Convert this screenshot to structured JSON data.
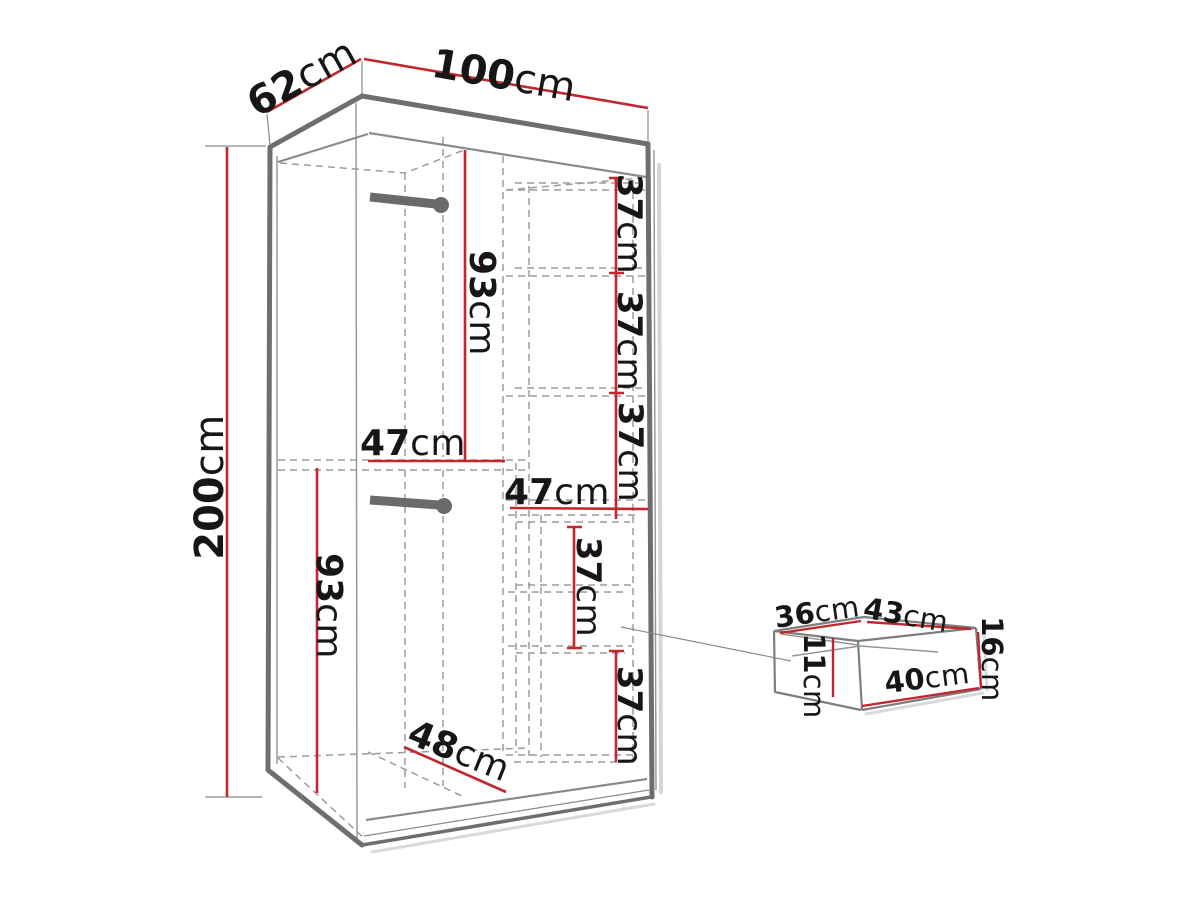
{
  "unit": "cm",
  "colors": {
    "dimension_line": "#c1272d",
    "outline": "#6e6e6e",
    "hidden_line": "#9c9c9c",
    "text": "#161616",
    "shadow": "#d5d5d5"
  },
  "overall_dimensions": {
    "width_cm": "100",
    "depth_cm": "62",
    "height_cm": "200"
  },
  "interior_dimensions": {
    "upper_hanging_height_cm": "93",
    "lower_hanging_height_cm": "93",
    "left_section_width_cm": "47",
    "right_section_width_cm": "47",
    "shelf_spacing_cm": [
      "37",
      "37",
      "37",
      "37",
      "37"
    ],
    "floor_depth_cm": "48"
  },
  "drawer_dimensions": {
    "inner_width_cm": "36",
    "inner_depth_cm": "43",
    "inner_height_cm": "11",
    "front_width_cm": "40",
    "height_cm": "16"
  },
  "labels": [
    {
      "id": "depth-top",
      "value": "62",
      "unit": "cm"
    },
    {
      "id": "width-top",
      "value": "100",
      "unit": "cm"
    },
    {
      "id": "height-left",
      "value": "200",
      "unit": "cm"
    },
    {
      "id": "upper-hang-height",
      "value": "93",
      "unit": "cm"
    },
    {
      "id": "left-section-width",
      "value": "47",
      "unit": "cm"
    },
    {
      "id": "shelf-gap-1",
      "value": "37",
      "unit": "cm"
    },
    {
      "id": "shelf-gap-2",
      "value": "37",
      "unit": "cm"
    },
    {
      "id": "shelf-gap-3",
      "value": "37",
      "unit": "cm"
    },
    {
      "id": "right-section-width",
      "value": "47",
      "unit": "cm"
    },
    {
      "id": "shelf-gap-4",
      "value": "37",
      "unit": "cm"
    },
    {
      "id": "shelf-gap-5",
      "value": "37",
      "unit": "cm"
    },
    {
      "id": "lower-hang-height",
      "value": "93",
      "unit": "cm"
    },
    {
      "id": "floor-depth",
      "value": "48",
      "unit": "cm"
    },
    {
      "id": "drawer-inner-width",
      "value": "36",
      "unit": "cm"
    },
    {
      "id": "drawer-inner-depth",
      "value": "43",
      "unit": "cm"
    },
    {
      "id": "drawer-inner-height",
      "value": "11",
      "unit": "cm"
    },
    {
      "id": "drawer-front-width",
      "value": "40",
      "unit": "cm"
    },
    {
      "id": "drawer-height",
      "value": "16",
      "unit": "cm"
    }
  ]
}
